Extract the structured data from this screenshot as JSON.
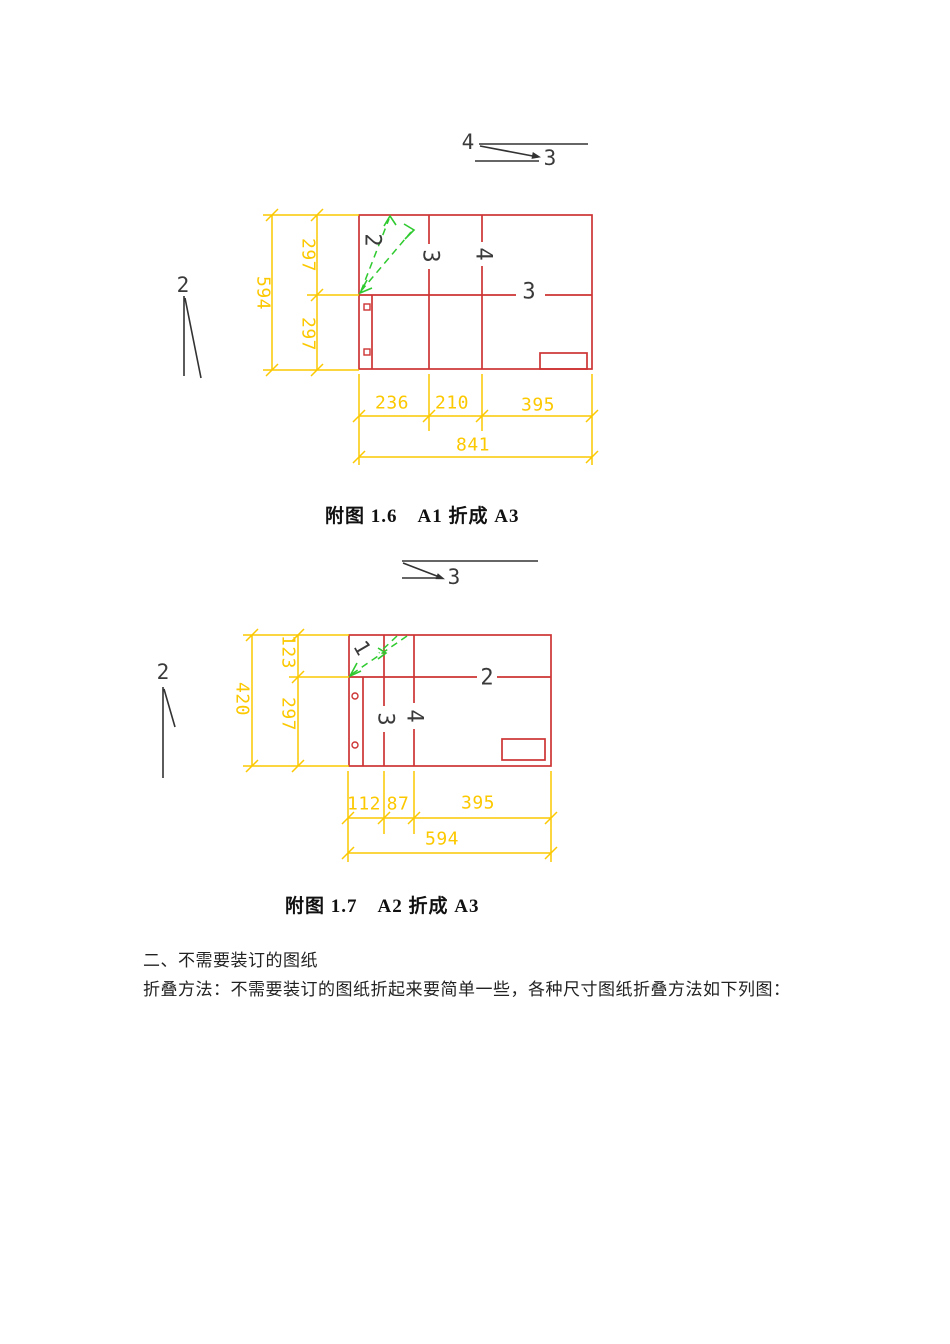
{
  "colors": {
    "red": "#cd3434",
    "yellow": "#fcc800",
    "green": "#2fca2f",
    "ink": "#333333"
  },
  "figure1": {
    "caption": "附图 1.6　A1 折成 A3",
    "arrow_labels": {
      "top": "4",
      "bottom": "3"
    },
    "left_step_label": "2",
    "panel_labels": {
      "fold_diagonal": "2",
      "vertical_1": "3",
      "vertical_2": "4",
      "horizontal_mid": "3"
    },
    "dimensions": {
      "height_total": "594",
      "height_top": "297",
      "height_bottom": "297",
      "width_seg1": "236",
      "width_seg2": "210",
      "width_seg3": "395",
      "width_total": "841"
    }
  },
  "figure2": {
    "caption": "附图 1.7　A2 折成 A3",
    "arrow_labels": {
      "bottom": "3"
    },
    "left_step_label": "2",
    "panel_labels": {
      "fold_diagonal": "1",
      "vertical_1": "3",
      "vertical_2": "4",
      "horizontal_mid": "2"
    },
    "dimensions": {
      "height_total": "420",
      "height_top": "123",
      "height_bottom": "297",
      "width_seg1": "112",
      "width_seg2": "87",
      "width_seg3": "395",
      "width_total": "594"
    }
  },
  "text": {
    "section_heading": "二、不需要装订的图纸",
    "paragraph": "折叠方法：不需要装订的图纸折起来要简单一些，各种尺寸图纸折叠方法如下列图："
  }
}
